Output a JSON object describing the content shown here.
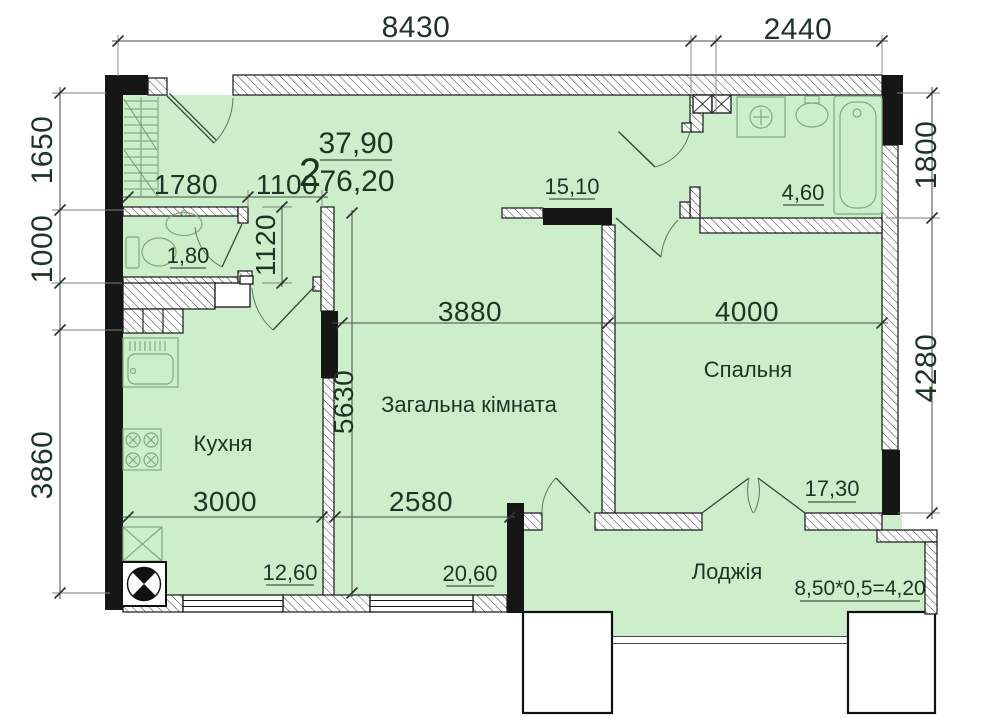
{
  "title": "2-room apartment floor plan",
  "apartment": {
    "rooms_count": "2",
    "living_area": "37,90",
    "total_area": "76,20"
  },
  "dims": {
    "top_main": "8430",
    "top_bath": "2440",
    "left_upper": "1650",
    "left_mid": "1000",
    "left_lower": "3860",
    "right_upper": "1800",
    "right_lower": "4280",
    "hall_left": "1780",
    "hall_right": "1100",
    "wc_height": "1120",
    "living_height": "5630",
    "living_width": "3880",
    "bedroom_width": "4000",
    "kitchen_width": "3000",
    "living_width_2": "2580"
  },
  "rooms": {
    "kitchen": {
      "name": "Кухня",
      "area": "12,60"
    },
    "living": {
      "name": "Загальна кімната",
      "area": "20,60"
    },
    "bedroom": {
      "name": "Спальня",
      "area": "17,30"
    },
    "loggia": {
      "name": "Лоджія",
      "area_formula": "8,50*0,5=4,20"
    },
    "wc": {
      "area": "1,80"
    },
    "hall": {
      "area": "15,10"
    },
    "bathroom": {
      "area": "4,60"
    }
  },
  "colors": {
    "room_fill": "#cdeecb",
    "wall": "#161616",
    "dimension_line": "#474f47",
    "text": "#1e3424",
    "fixture": "#7dab7d"
  }
}
